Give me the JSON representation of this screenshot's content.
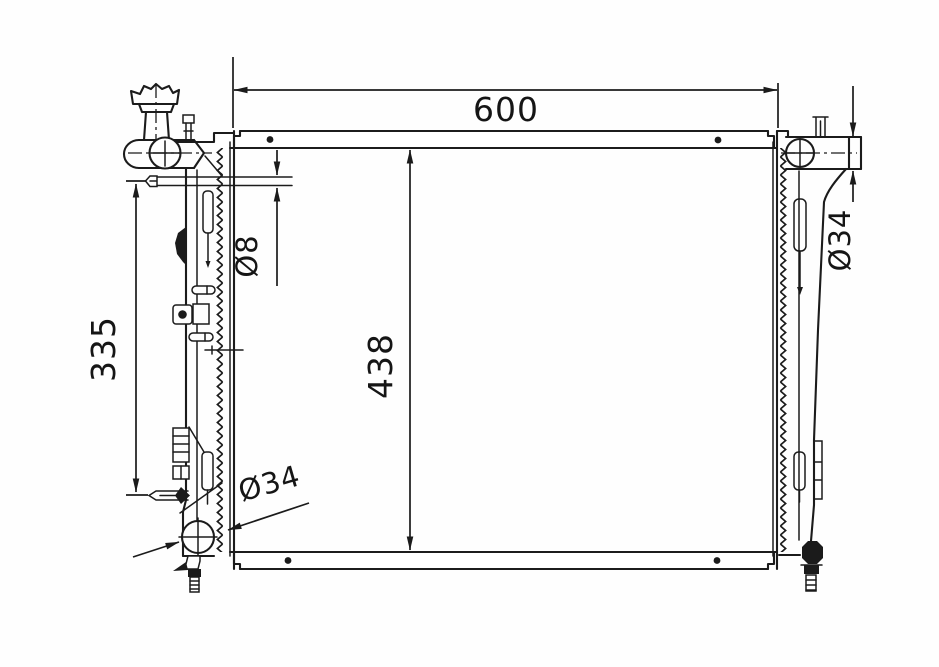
{
  "diagram": {
    "type": "engineering-drawing",
    "subject": "radiator-front-view",
    "background": "#fefefe",
    "ink": "#1b1b1b",
    "labels": {
      "core_width": "600",
      "core_height": "438",
      "left_pin_span": "335",
      "overflow_tube_dia": "Ø8",
      "outlet_port_dia": "Ø34",
      "inlet_port_dia": "Ø34"
    }
  }
}
